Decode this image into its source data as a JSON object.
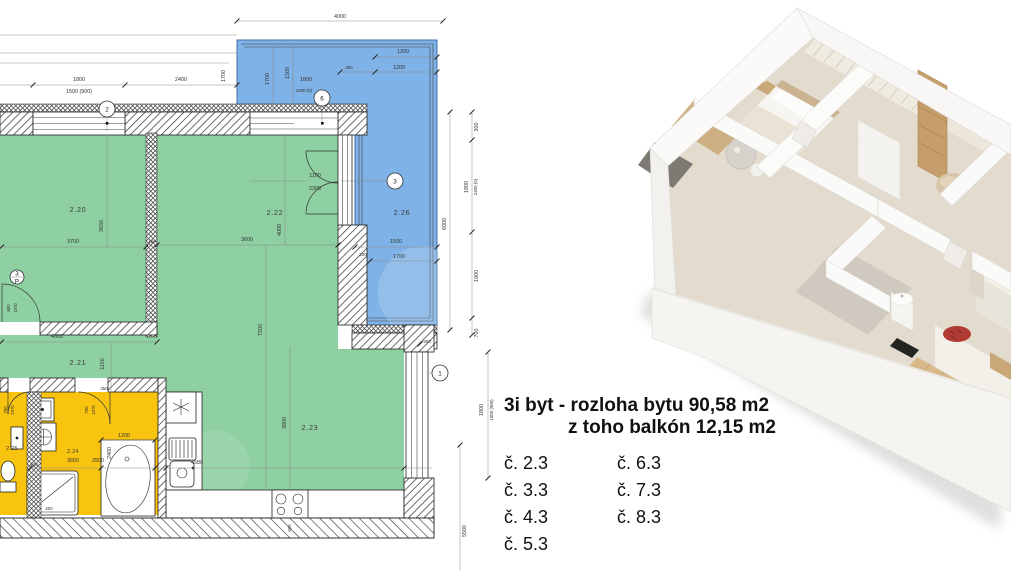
{
  "info": {
    "title_line1": "3i byt - rozloha bytu 90,58 m2",
    "title_line2": "z toho balkón 12,15 m2",
    "units_col1": [
      "č. 2.3",
      "č. 3.3",
      "č. 4.3",
      "č. 5.3"
    ],
    "units_col2": [
      "č. 6.3",
      "č. 7.3",
      "č. 8.3"
    ]
  },
  "colors": {
    "room_green": "#8ed0a1",
    "balcony_blue": "#7fb2e6",
    "bath_yellow": "#f8c40f",
    "wall_line": "#1c1c1c",
    "dim_text": "#333333"
  },
  "rooms": {
    "r220": "2.20",
    "r221": "2.21",
    "r222": "2.22",
    "r223": "2.23",
    "r224": "2.24",
    "r225": "2.25",
    "r226": "2.26"
  },
  "markers": {
    "m1": "1",
    "m2": "2",
    "m3": "3",
    "m6": "6",
    "p": "P"
  },
  "dims": {
    "d4000": "4000",
    "d1800": "1800",
    "d1500_900": "1500 (900)",
    "d2400": "2400",
    "d1700": "1700",
    "d1500": "1500",
    "d2400_0": "2400 (0)",
    "d300": "300",
    "d1200": "1200",
    "d200": "200",
    "d100": "100",
    "d150": "150",
    "d350": "350",
    "d500": "500",
    "d700": "700",
    "d800": "800",
    "d1970": "1970",
    "d1100": "1100",
    "d2300": "2300",
    "d3700": "3700",
    "d3650": "3650",
    "d3600": "3600",
    "d4580": "4580",
    "d3800": "3800",
    "d2500": "2500",
    "d1150": "1150",
    "d1900": "1900",
    "d6000": "6000",
    "d7200": "7200",
    "d5500": "5500",
    "d600": "600"
  }
}
